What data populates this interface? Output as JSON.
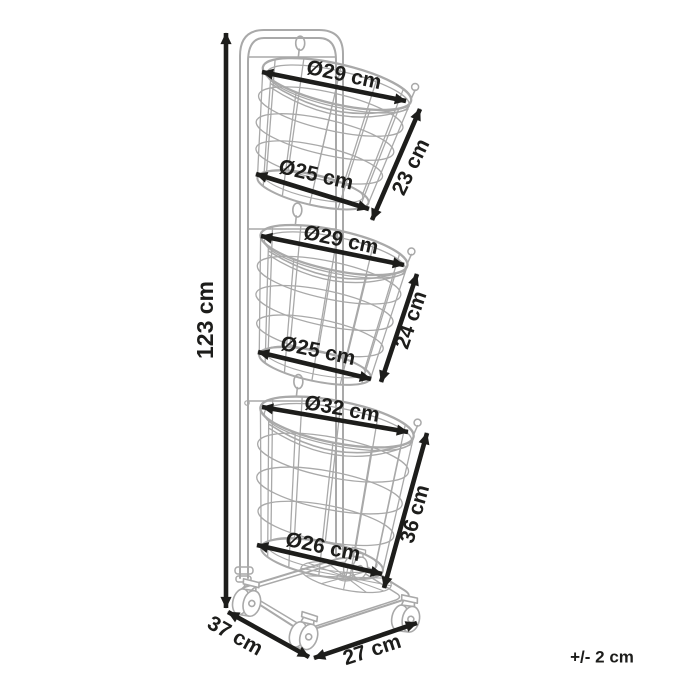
{
  "labels": {
    "overall_height": "123 cm",
    "depth": "37 cm",
    "width": "27 cm",
    "tolerance": "+/- 2 cm"
  },
  "baskets": [
    {
      "top_diameter": "Ø29 cm",
      "bottom_diameter": "Ø25 cm",
      "side_height": "23 cm"
    },
    {
      "top_diameter": "Ø29 cm",
      "bottom_diameter": "Ø25 cm",
      "side_height": "24 cm"
    },
    {
      "top_diameter": "Ø32 cm",
      "bottom_diameter": "Ø26 cm",
      "side_height": "36 cm"
    }
  ],
  "colors": {
    "artwork_line": "#a9a9a9",
    "dimension_ink": "#1d1d1b",
    "background": "#ffffff"
  }
}
